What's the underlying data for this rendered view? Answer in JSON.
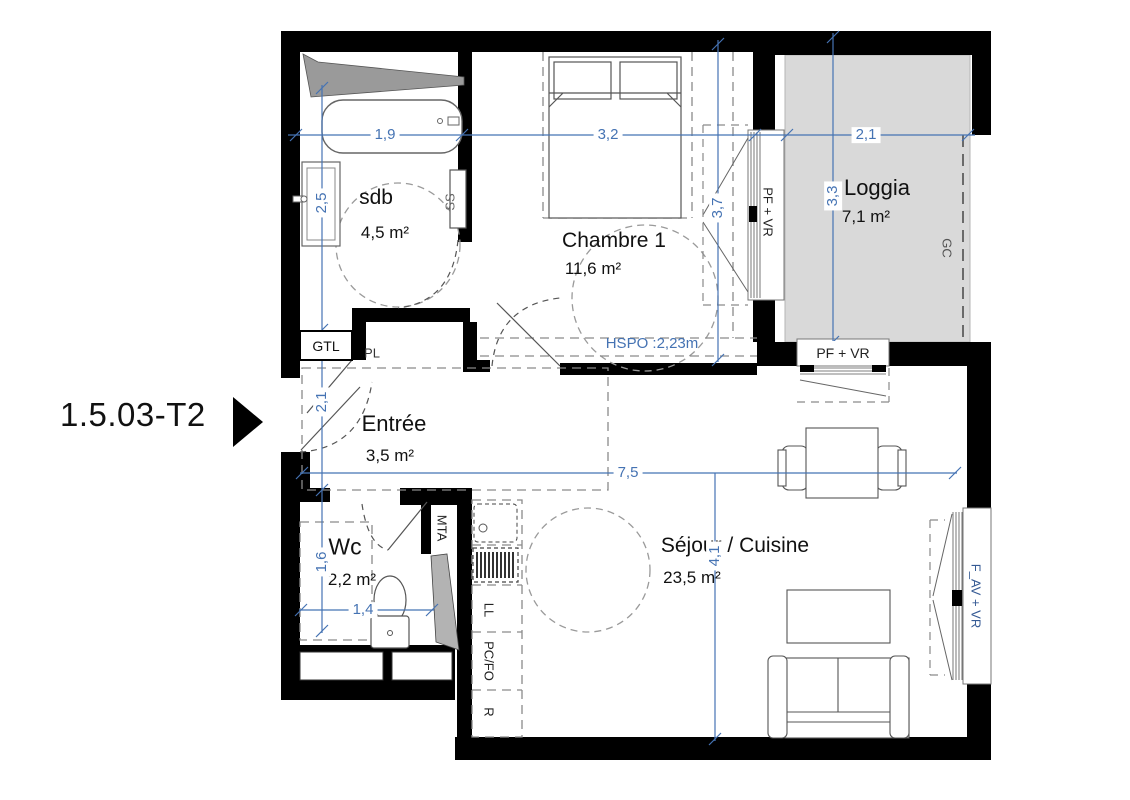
{
  "title": {
    "unit_label": "1.5.03-T2"
  },
  "rooms": {
    "sdb": {
      "name": "sdb",
      "area": "4,5 m²"
    },
    "chambre": {
      "name": "Chambre 1",
      "area": "11,6 m²"
    },
    "loggia": {
      "name": "Loggia",
      "area": "7,1 m²"
    },
    "entree": {
      "name": "Entrée",
      "area": "3,5 m²"
    },
    "wc": {
      "name": "Wc",
      "area": "2,2 m²"
    },
    "sejour": {
      "name": "Séjour / Cuisine",
      "area": "23,5 m²"
    }
  },
  "dimensions": {
    "sdb_width": "1,9",
    "chambre_width": "3,2",
    "loggia_width": "2,1",
    "sdb_depth": "2,5",
    "entree_depth": "2,1",
    "wc_depth": "1,6",
    "wc_width": "1,4",
    "chambre_depth": "3,7",
    "loggia_depth": "3,3",
    "sejour_width": "7,5",
    "sejour_depth": "4,1",
    "ceiling_note": "HSPO :2,23m"
  },
  "annotations": {
    "gtl": "GTL",
    "pl": "PL",
    "ss": "SS",
    "mta": "MTA",
    "ll": "LL",
    "pc_fo": "PC/FO",
    "r": "R",
    "gc": "GC",
    "window_chambre": "PF + VR",
    "window_loggia": "PF + VR",
    "window_sejour": "F_AV + VR"
  },
  "colors": {
    "dimension_blue": "#4573b3",
    "wall": "#000000",
    "loggia_fill": "#d9d9d9"
  }
}
